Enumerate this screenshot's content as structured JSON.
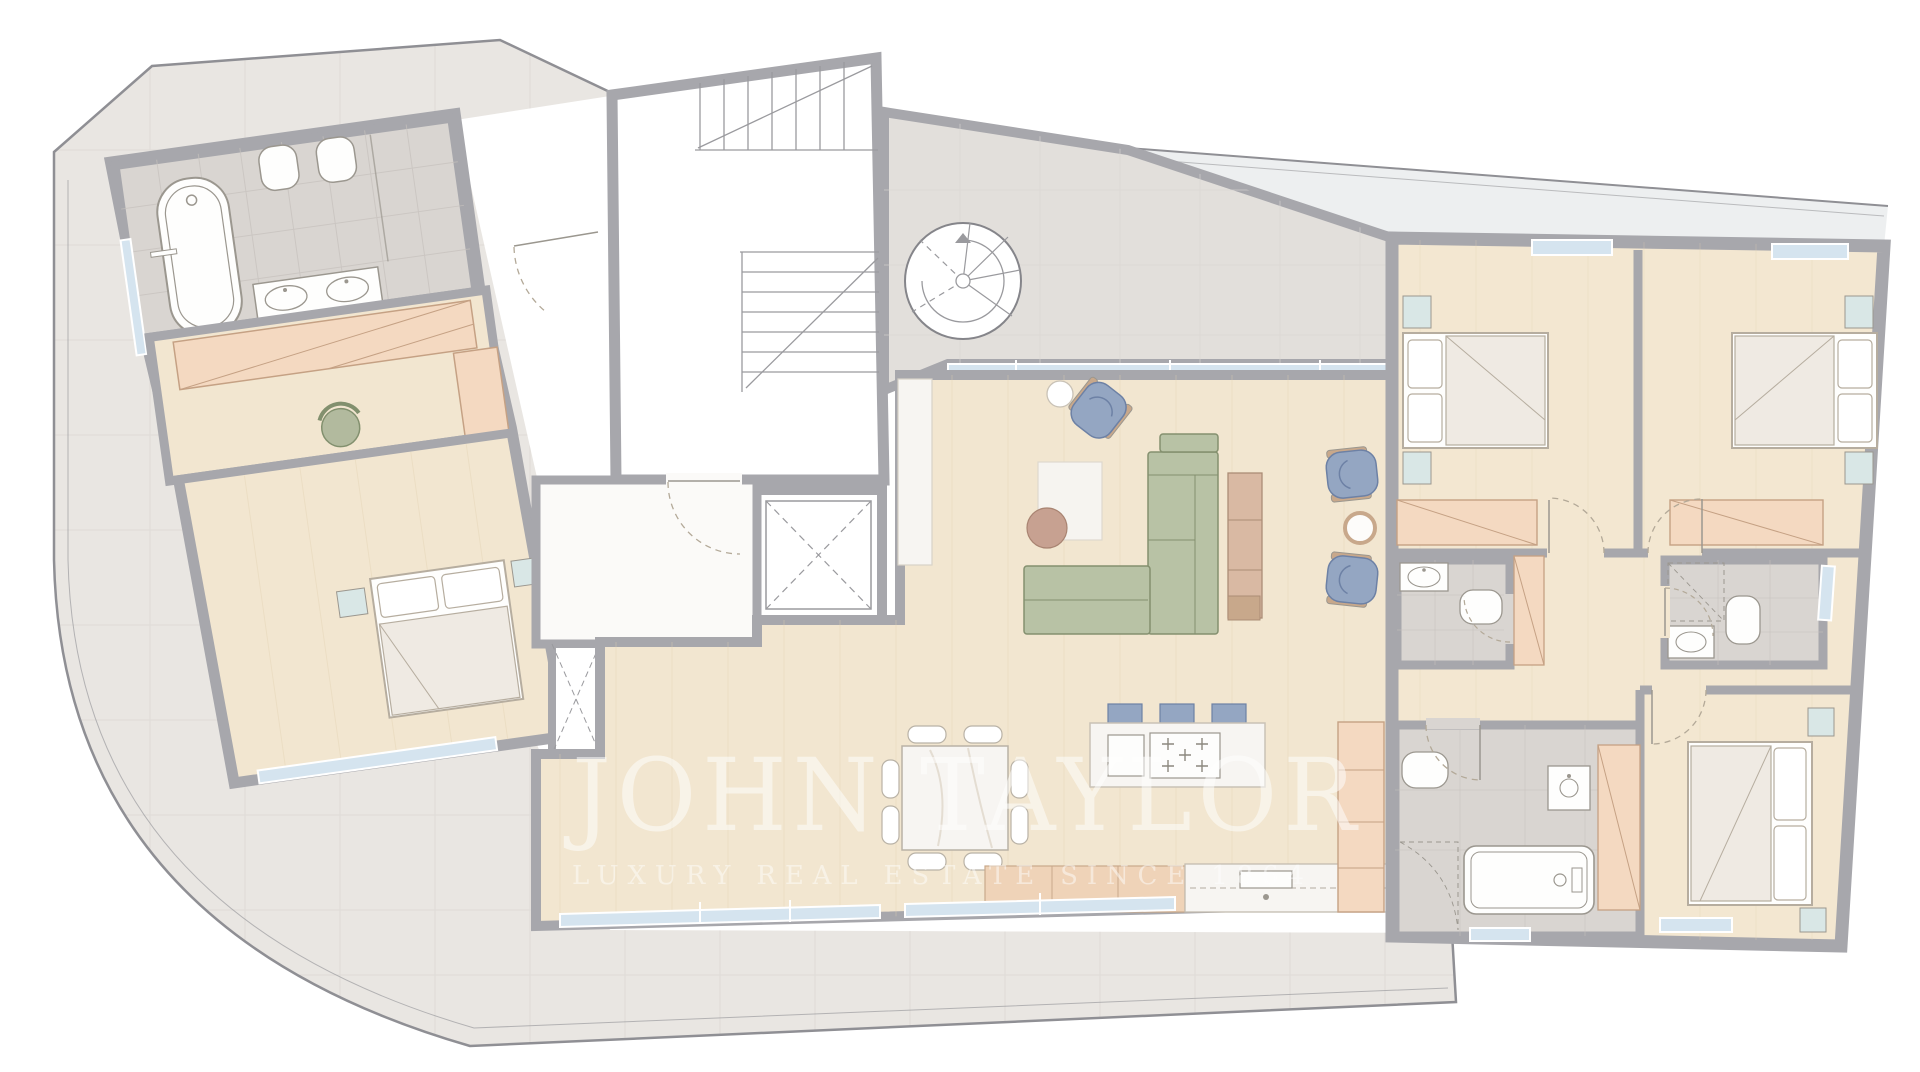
{
  "watermark": {
    "brand": "JOHN TAYLOR",
    "tagline": "LUXURY REAL ESTATE SINCE 1864",
    "color": "#ffffff",
    "brand_opacity": 0.52,
    "tagline_opacity": 0.48
  },
  "palette": {
    "wall": "#a7a7ac",
    "outline": "#8f8f94",
    "terrace": "#e9e6e2",
    "terrace-light": "#edeff0",
    "tile-line": "#d9d6d2",
    "wood": "#f2e6d0",
    "plank-line": "#e3d2b2",
    "marble": "#f7f5f2",
    "bath": "#d9d5d1",
    "bath-line": "#c6c1bd",
    "glass": "#d5e4ef",
    "nightstand": "#d9e7e6",
    "sofa": "#b8c2a5",
    "sofa-line": "#84906f",
    "chair-blue": "#94a6c2",
    "chair-blue-line": "#6d81a5",
    "wood-accent": "#c8a88b",
    "sideboard": "#d9b9a3",
    "wardrobe": "#f4d9c1",
    "wardrobe-line": "#c5a184",
    "cabinet": "#efd3b8",
    "fixture": "#fefefd",
    "fixture-line": "#9b978f",
    "rug": "#f6f4f0",
    "coffee": "#c7a191",
    "stairs-line": "#9a9a9e",
    "door-arc": "#b3a998"
  },
  "fixtures": [
    "bathtub",
    "toilet",
    "washbasin",
    "double-vanity",
    "shower",
    "double-bed",
    "nightstand",
    "wardrobe",
    "dressing-chair",
    "l-shaped-sofa",
    "armchair",
    "side-table",
    "coffee-table",
    "rug",
    "sideboard",
    "dining-table",
    "dining-chair",
    "kitchen-island",
    "bar-stool",
    "hob",
    "kitchen-sink",
    "kitchen-cabinet",
    "pantry-cabinet",
    "switchback-staircase",
    "spiral-staircase",
    "elevator",
    "window",
    "sliding-glass-door",
    "door-swing",
    "terrace",
    "curved-balcony"
  ]
}
